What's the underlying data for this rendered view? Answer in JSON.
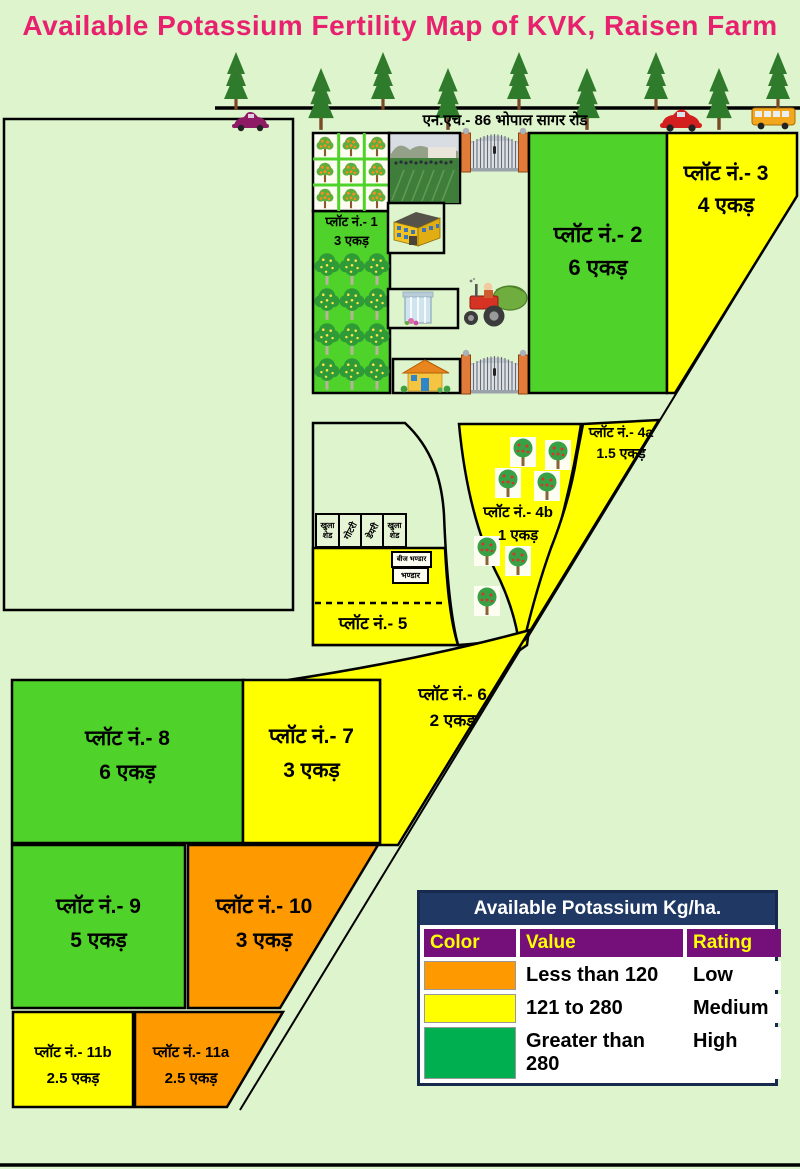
{
  "title": "Available Potassium Fertility Map of KVK, Raisen Farm",
  "road": {
    "label": "एन.एच.- 86  भोपाल सागर रोड"
  },
  "plots": {
    "p1": {
      "name": "प्लॉट नं.- 1",
      "area": "3 एकड़",
      "rating": "High"
    },
    "p2": {
      "name": "प्लॉट नं.- 2",
      "area": "6 एकड़",
      "rating": "High"
    },
    "p3": {
      "name": "प्लॉट नं.- 3",
      "area": "4 एकड़",
      "rating": "Medium"
    },
    "p4a": {
      "name": "प्लॉट नं.- 4a",
      "area": "1.5 एकड़",
      "rating": "Medium"
    },
    "p4b": {
      "name": "प्लॉट नं.- 4b",
      "area": "1 एकड़",
      "rating": "Medium"
    },
    "p5": {
      "name": "प्लॉट नं.- 5",
      "area": "",
      "rating": "Medium"
    },
    "p6": {
      "name": "प्लॉट नं.- 6",
      "area": "2 एकड़",
      "rating": "Medium"
    },
    "p7": {
      "name": "प्लॉट नं.- 7",
      "area": "3 एकड़",
      "rating": "Medium"
    },
    "p8": {
      "name": "प्लॉट नं.- 8",
      "area": "6 एकड़",
      "rating": "High"
    },
    "p9": {
      "name": "प्लॉट नं.- 9",
      "area": "5 एकड़",
      "rating": "High"
    },
    "p10": {
      "name": "प्लॉट नं.- 10",
      "area": "3 एकड़",
      "rating": "Low"
    },
    "p11a": {
      "name": "प्लॉट नं.- 11a",
      "area": "2.5 एकड़",
      "rating": "Low"
    },
    "p11b": {
      "name": "प्लॉट नं.- 11b",
      "area": "2.5 एकड़",
      "rating": "Medium"
    }
  },
  "buildings": {
    "shed1": "खुला शेड",
    "shed2": "गोटरी",
    "shed3": "डेयरी",
    "shed4": "खुला शेड",
    "store1": "बीज भण्डार",
    "store2": "भण्डार"
  },
  "legend": {
    "title": "Available Potassium Kg/ha.",
    "columns": {
      "color": "Color",
      "value": "Value",
      "rating": "Rating"
    },
    "rows": [
      {
        "swatch": "#FF9900",
        "value": "Less than 120",
        "rating": "Low"
      },
      {
        "swatch": "#FFFF00",
        "value": "121 to 280",
        "rating": "Medium"
      },
      {
        "swatch": "#00B050",
        "value": "Greater than 280",
        "rating": "High"
      }
    ]
  },
  "colors": {
    "background": "#DEF4CC",
    "plot_green": "#4FD32A",
    "plot_yellow": "#FFFF00",
    "plot_orange": "#FF9900",
    "title_pink": "#E8216F",
    "legend_navy": "#1F3864",
    "legend_purple": "#75107A",
    "legend_green": "#00B050"
  }
}
